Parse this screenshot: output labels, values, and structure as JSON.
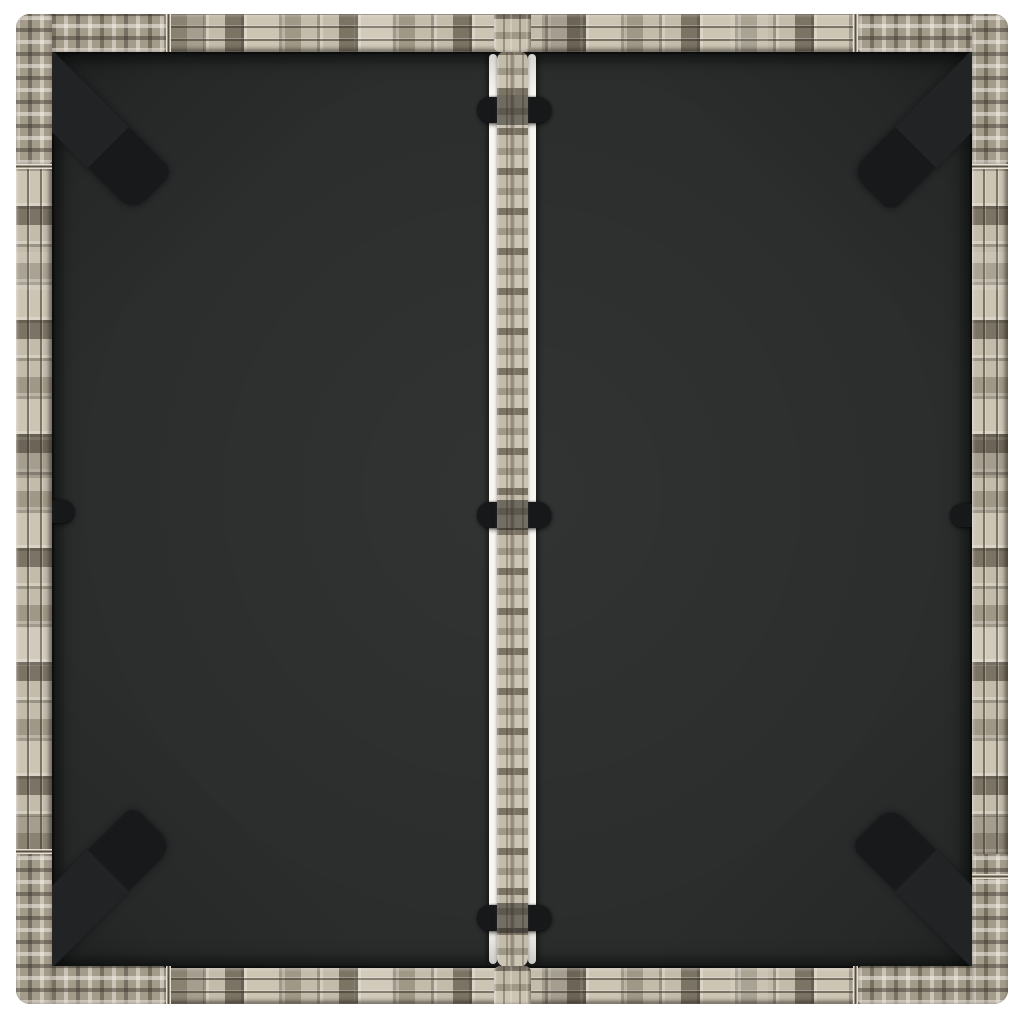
{
  "image_type": "product-photo",
  "subject": "Top-down view of a square gray poly rattan garden table with a black glass top, white studio background",
  "background_color": "#ffffff",
  "colors": {
    "background": "#ffffff",
    "rattan_base": "#b2aa9a",
    "rattan_light": "#cdc5b4",
    "rattan_light2": "#c4bcab",
    "rattan_mid": "#a09886",
    "rattan_dark": "#7b7364",
    "glass": "#2b2d2d",
    "leg": "#202223",
    "clip": "#17181a",
    "glare": "#f8f6f0"
  },
  "clips": [
    {
      "name": "strip-clip-top",
      "x": 461,
      "y": 83,
      "w": 74,
      "h": 26,
      "shape": "stadium"
    },
    {
      "name": "strip-clip-middle",
      "x": 461,
      "y": 488,
      "w": 74,
      "h": 26,
      "shape": "stadium"
    },
    {
      "name": "strip-clip-bottom",
      "x": 461,
      "y": 891,
      "w": 74,
      "h": 26,
      "shape": "stadium"
    },
    {
      "name": "left-frame-clip",
      "x": 32,
      "y": 486,
      "w": 26,
      "h": 23,
      "shape": "round-right"
    },
    {
      "name": "right-frame-clip",
      "x": 934,
      "y": 490,
      "w": 26,
      "h": 23,
      "shape": "round-left"
    }
  ],
  "legs": [
    {
      "name": "table-leg-top-left",
      "corner": "tl"
    },
    {
      "name": "table-leg-top-right",
      "corner": "tr"
    },
    {
      "name": "table-leg-bottom-left",
      "corner": "bl"
    },
    {
      "name": "table-leg-bottom-right",
      "corner": "br"
    }
  ]
}
